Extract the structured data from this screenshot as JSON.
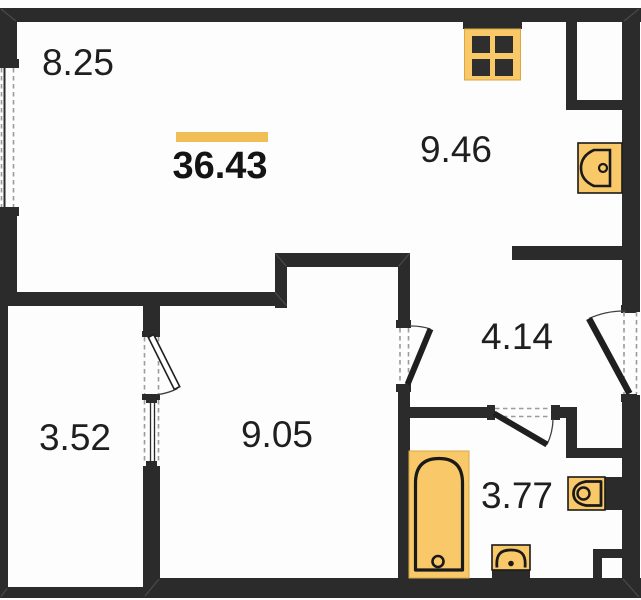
{
  "floorplan": {
    "title": "apartment-floor-plan",
    "total_area": {
      "value": "36.43"
    },
    "rooms": [
      {
        "id": "living-area",
        "area": "8.25"
      },
      {
        "id": "kitchen",
        "area": "9.46"
      },
      {
        "id": "hallway",
        "area": "4.14"
      },
      {
        "id": "storage",
        "area": "3.52"
      },
      {
        "id": "bedroom",
        "area": "9.05"
      },
      {
        "id": "bathroom",
        "area": "3.77"
      }
    ],
    "fixtures": [
      "stove-icon",
      "kitchen-sink-icon",
      "bathtub-icon",
      "toilet-icon",
      "bathroom-sink-icon"
    ],
    "colors": {
      "wall": "#2b2b2b",
      "fixture_fill": "#f9c869",
      "fixture_stroke": "#1a1a1a",
      "accent": "#f1bd56",
      "dash": "#9b9b9b",
      "burner": "#2e2e2e"
    }
  }
}
